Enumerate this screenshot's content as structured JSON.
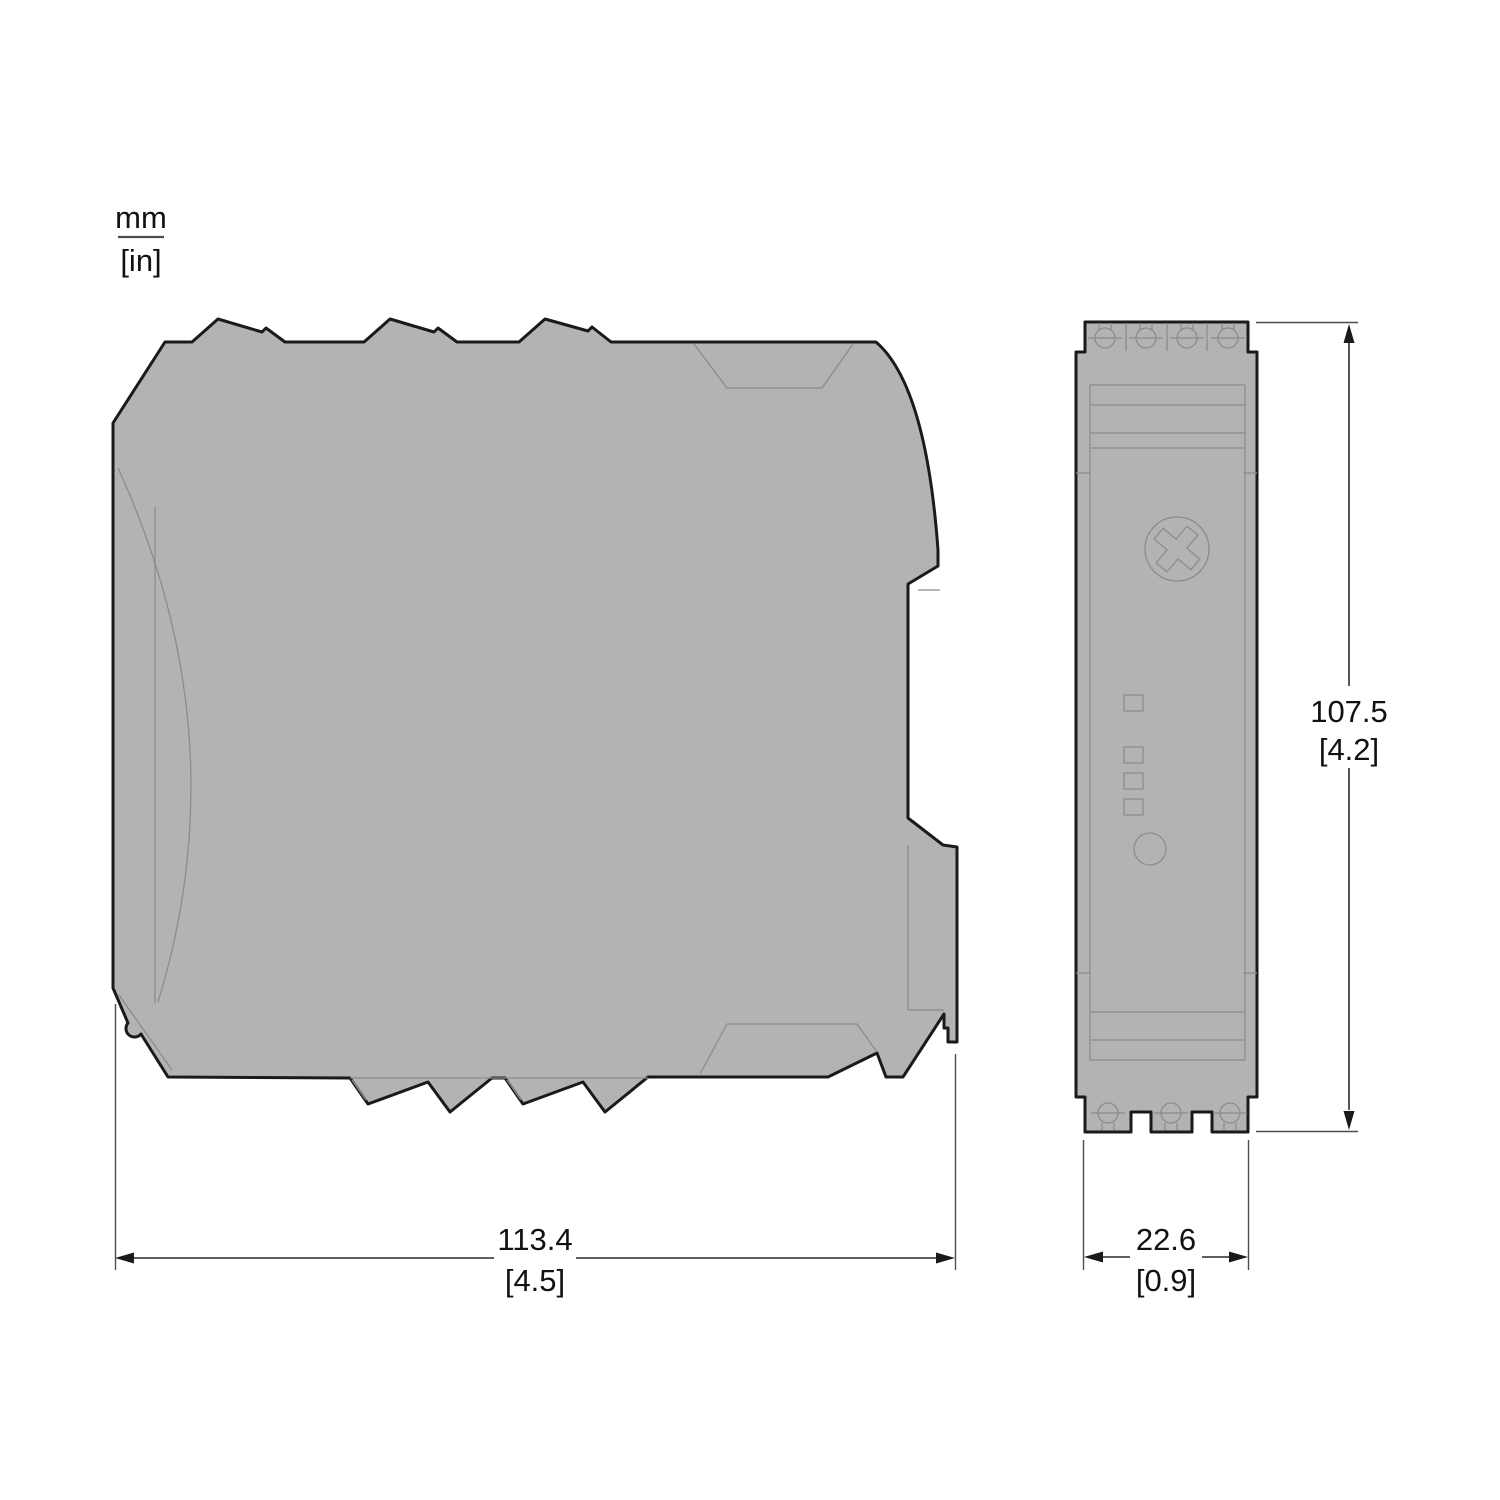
{
  "drawing": {
    "title": "device-dimension-drawing",
    "views": {
      "side": "side-view-of-din-rail-module",
      "front": "front-view-of-din-rail-module"
    }
  },
  "legend": {
    "unit_primary": "mm",
    "unit_secondary": "[in]"
  },
  "dimensions": {
    "width": {
      "mm": "113.4",
      "in": "[4.5]"
    },
    "height": {
      "mm": "107.5",
      "in": "[4.2]"
    },
    "depth": {
      "mm": "22.6",
      "in": "[0.9]"
    }
  },
  "colors": {
    "body_fill": "#b3b3b3",
    "outline": "#1a1a1a",
    "inner_line": "#8c8c8c",
    "dimension_line": "#2b2b2b",
    "background": "#ffffff"
  }
}
